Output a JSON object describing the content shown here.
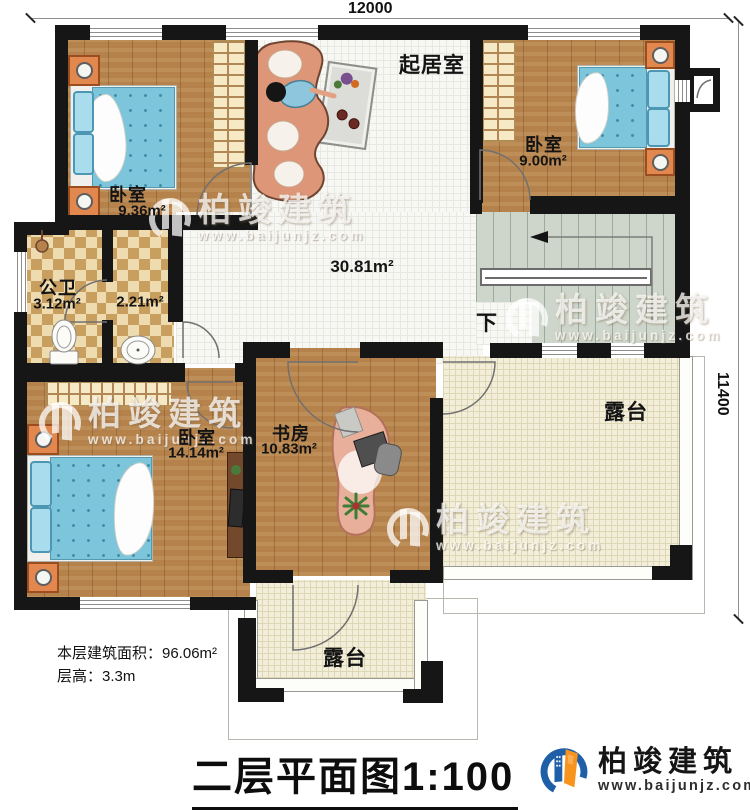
{
  "dimensions": {
    "top": "12000",
    "right": "11400"
  },
  "rooms": {
    "bedroom_top_left": {
      "name": "卧室",
      "area": "9.36m²"
    },
    "bedroom_top_right": {
      "name": "卧室",
      "area": "9.00m²"
    },
    "living_room": {
      "name": "起居室",
      "area": "30.81m²"
    },
    "bathroom": {
      "name": "公卫",
      "area": "3.12m²"
    },
    "washroom": {
      "area": "2.21m²"
    },
    "bedroom_bottom_left": {
      "name": "卧室",
      "area": "14.14m²"
    },
    "study": {
      "name": "书房",
      "area": "10.83m²"
    },
    "stairs": {
      "down_label": "下"
    },
    "terrace_right": {
      "name": "露台"
    },
    "terrace_bottom": {
      "name": "露台"
    }
  },
  "notes": {
    "floor_area": "本层建筑面积：96.06m²",
    "floor_height": "层高：3.3m"
  },
  "title": "二层平面图1:100",
  "logo": {
    "company": "柏竣建筑",
    "website": "www.baijunjz.com"
  },
  "watermark": {
    "company": "柏竣建筑",
    "website": "www.baijunjz.com"
  },
  "colors": {
    "wall": "#161616",
    "wood_floor": "#b5824c",
    "tile_floor": "#f7f7f4",
    "checker_tan": "#c99f60",
    "stairs": "#ced6cb",
    "terrace": "#f2eeda",
    "bed_blue": "#7cc5da",
    "furniture_salmon": "#dd9678",
    "accent_orange": "#e2874e",
    "logo_blue": "#1e5fa8",
    "logo_orange": "#f7941d"
  }
}
